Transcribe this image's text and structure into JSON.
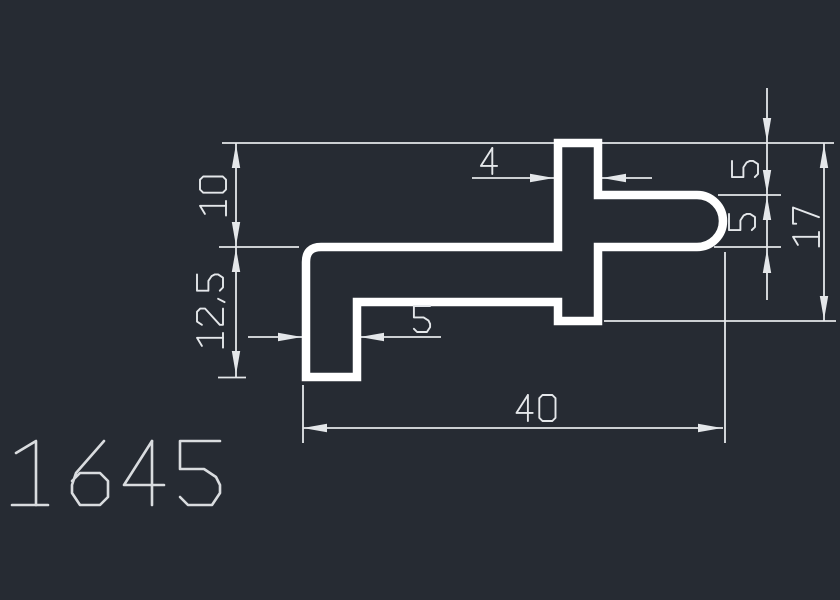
{
  "drawing": {
    "part_number": "1645",
    "dimensions": [
      {
        "id": "tab-width",
        "label": "4",
        "value": 4
      },
      {
        "id": "upper-height",
        "label": "10",
        "value": 10
      },
      {
        "id": "lower-height",
        "label": "12,5",
        "value": 12.5
      },
      {
        "id": "right-upper",
        "label": "5",
        "value": 5
      },
      {
        "id": "right-lower",
        "label": "5",
        "value": 5
      },
      {
        "id": "right-total",
        "label": "17",
        "value": 17
      },
      {
        "id": "leg-width",
        "label": "5",
        "value": 5
      },
      {
        "id": "total-width",
        "label": "40",
        "value": 40
      }
    ],
    "colors": {
      "background": "#262b33",
      "profile_line": "#ffffff",
      "dimension_line": "#e4e7ea",
      "dimension_text": "#e4e7ea",
      "part_number_text": "#d9dcdf"
    }
  }
}
